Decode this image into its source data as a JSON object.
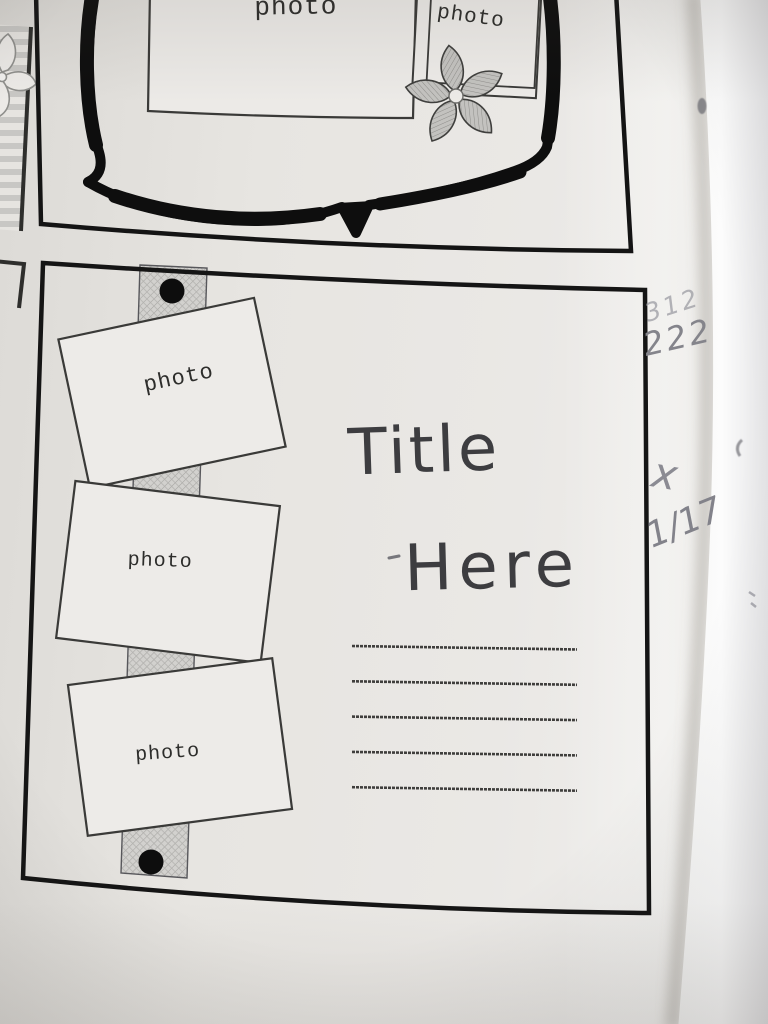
{
  "book_page": {
    "top_sketch": {
      "large_photo_label": "photo",
      "small_photo_label": "photo"
    },
    "bottom_sketch": {
      "photo_labels": [
        "photo",
        "photo",
        "photo"
      ],
      "title": {
        "line1": "Title",
        "line2": "Here"
      },
      "journal_line_count": 5
    },
    "pencil_annotations": {
      "faint_numbers": "312",
      "numbers": "222",
      "check_mark": "x",
      "date": "1/17"
    },
    "colors": {
      "ink": "#1c1c1c",
      "paper": "#e8e6e2",
      "embellishment_gray": "#bdbcb9",
      "pencil_gray": "#86868e"
    }
  }
}
